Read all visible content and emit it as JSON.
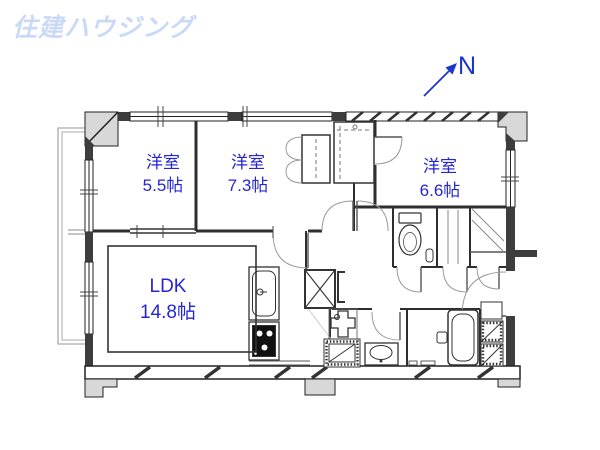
{
  "logo": {
    "text": "住建ハウジング",
    "color": "#c9d9f7"
  },
  "compass": {
    "label": "N",
    "color": "#1a35cc"
  },
  "rooms": [
    {
      "name": "洋室",
      "size": "5.5帖"
    },
    {
      "name": "洋室",
      "size": "7.3帖"
    },
    {
      "name": "洋室",
      "size": "6.6帖"
    },
    {
      "name": "LDK",
      "size": "14.8帖"
    }
  ],
  "colors": {
    "room_label": "#2525d6",
    "wall": "#3d3d3d"
  }
}
